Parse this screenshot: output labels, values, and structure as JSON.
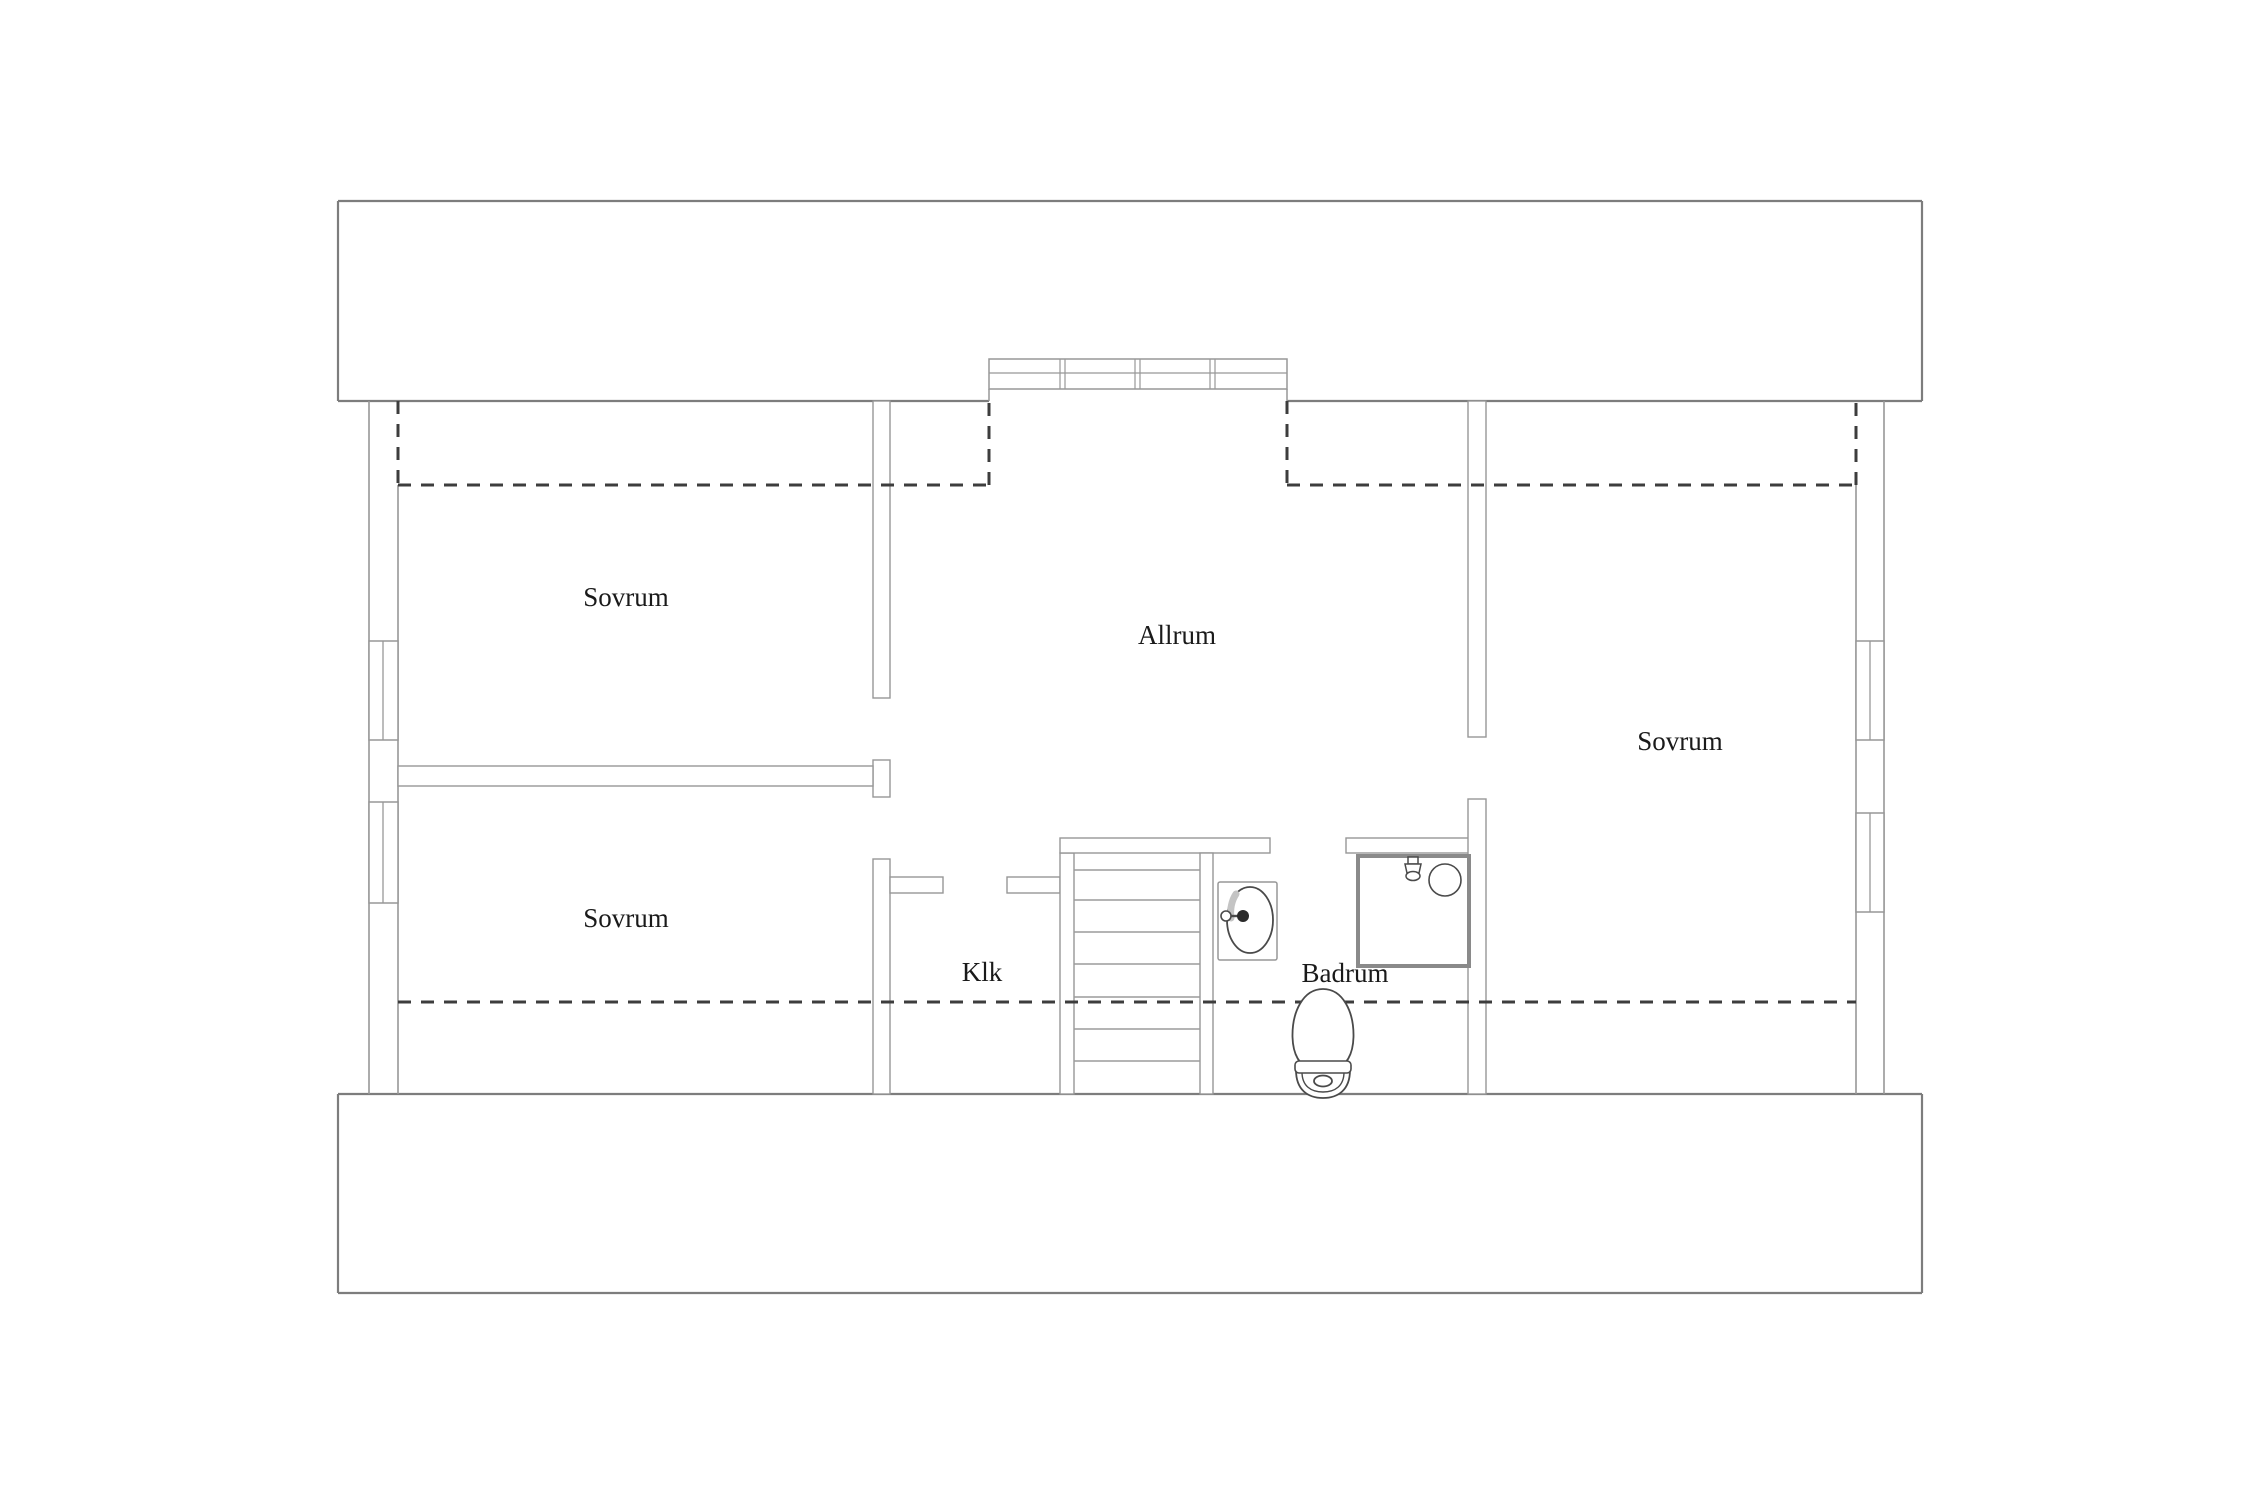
{
  "document": {
    "kind": "floor-plan",
    "language": "Swedish"
  },
  "canvas": {
    "width": 2250,
    "height": 1500,
    "background": "#ffffff"
  },
  "colors": {
    "outer_band_stroke": "#7d7d7d",
    "wall_stroke": "#979797",
    "thin_line": "#9c9c9c",
    "dashed_line": "#3d3d3d",
    "fixture_stroke": "#4a4a4a",
    "shower_stroke": "#8a8a8a",
    "shade": "#c4c4c4",
    "text": "#1a1a1a",
    "fill": "#ffffff"
  },
  "rooms": [
    {
      "id": "sovrum-top-left",
      "label": "Sovrum",
      "x": 626,
      "y": 606
    },
    {
      "id": "sovrum-bottom-left",
      "label": "Sovrum",
      "x": 626,
      "y": 927
    },
    {
      "id": "allrum",
      "label": "Allrum",
      "x": 1177,
      "y": 644
    },
    {
      "id": "sovrum-right",
      "label": "Sovrum",
      "x": 1680,
      "y": 750
    },
    {
      "id": "klk",
      "label": "Klk",
      "x": 982,
      "y": 981
    },
    {
      "id": "badrum",
      "label": "Badrum",
      "x": 1345,
      "y": 982
    }
  ],
  "label_font_size": 27,
  "outer_bands": [
    {
      "id": "top-band",
      "x": 338,
      "y": 201,
      "w": 1584,
      "h": 200,
      "bottom_gap": [
        989,
        1287
      ]
    },
    {
      "id": "bottom-band",
      "x": 338,
      "y": 1094,
      "w": 1584,
      "h": 199,
      "bottom_gap": null
    }
  ],
  "exterior_wall_lines": [
    {
      "id": "left-outer",
      "x1": 369,
      "y1": 401,
      "x2": 369,
      "y2": 1094
    },
    {
      "id": "left-inner",
      "x1": 398,
      "y1": 485,
      "x2": 398,
      "y2": 1094
    },
    {
      "id": "right-outer",
      "x1": 1884,
      "y1": 401,
      "x2": 1884,
      "y2": 1094
    },
    {
      "id": "right-inner",
      "x1": 1856,
      "y1": 485,
      "x2": 1856,
      "y2": 1094
    }
  ],
  "windows": [
    {
      "id": "left-window-upper",
      "x": 369,
      "y": 641,
      "w": 29,
      "h": 99,
      "center_x": 383
    },
    {
      "id": "left-window-lower",
      "x": 369,
      "y": 802,
      "w": 29,
      "h": 101,
      "center_x": 383
    },
    {
      "id": "right-window-upper",
      "x": 1856,
      "y": 641,
      "w": 28,
      "h": 99,
      "center_x": 1870
    },
    {
      "id": "right-window-lower",
      "x": 1856,
      "y": 813,
      "w": 28,
      "h": 99,
      "center_x": 1870
    }
  ],
  "dormer_window": {
    "x": 989,
    "y": 359,
    "w": 298,
    "h": 30,
    "mid_line_y": 373,
    "jamb_bottom_y": 401,
    "mullion_xs": [
      1060,
      1135,
      1210
    ],
    "mullion_gap": 5
  },
  "interior_walls": [
    {
      "id": "wall-sovrumTL-allrum",
      "x": 873,
      "y": 401,
      "w": 17,
      "h": 297
    },
    {
      "id": "wall-t-cap",
      "x": 873,
      "y": 760,
      "w": 17,
      "h": 37
    },
    {
      "id": "wall-between-left-sovrum",
      "x": 398,
      "y": 766,
      "w": 475,
      "h": 20
    },
    {
      "id": "wall-klk-left",
      "x": 873,
      "y": 859,
      "w": 17,
      "h": 235
    },
    {
      "id": "wall-klk-door-stub-left",
      "x": 890,
      "y": 877,
      "w": 53,
      "h": 16
    },
    {
      "id": "wall-klk-door-stub-right",
      "x": 1007,
      "y": 877,
      "w": 53,
      "h": 16
    },
    {
      "id": "wall-klk-stair",
      "x": 1060,
      "y": 853,
      "w": 14,
      "h": 241
    },
    {
      "id": "wall-stair-top",
      "x": 1060,
      "y": 838,
      "w": 210,
      "h": 15
    },
    {
      "id": "wall-stair-right",
      "x": 1200,
      "y": 853,
      "w": 13,
      "h": 241
    },
    {
      "id": "wall-badrum-top",
      "x": 1346,
      "y": 838,
      "w": 123,
      "h": 15
    },
    {
      "id": "wall-allrum-sovrumR",
      "x": 1468,
      "y": 401,
      "w": 18,
      "h": 336
    },
    {
      "id": "wall-badrum-right",
      "x": 1468,
      "y": 799,
      "w": 18,
      "h": 295
    }
  ],
  "dashed_lines": [
    {
      "id": "knee-wall-top-left-v",
      "pts": [
        [
          398,
          401
        ],
        [
          398,
          485
        ]
      ]
    },
    {
      "id": "knee-wall-top-left-h",
      "pts": [
        [
          398,
          485
        ],
        [
          989,
          485
        ]
      ]
    },
    {
      "id": "knee-wall-dormer-left",
      "pts": [
        [
          989,
          485
        ],
        [
          989,
          401
        ]
      ]
    },
    {
      "id": "knee-wall-dormer-right",
      "pts": [
        [
          1287,
          401
        ],
        [
          1287,
          485
        ]
      ]
    },
    {
      "id": "knee-wall-top-right-h",
      "pts": [
        [
          1287,
          485
        ],
        [
          1856,
          485
        ]
      ]
    },
    {
      "id": "knee-wall-top-right-v",
      "pts": [
        [
          1856,
          485
        ],
        [
          1856,
          401
        ]
      ]
    },
    {
      "id": "knee-wall-bottom",
      "pts": [
        [
          398,
          1002
        ],
        [
          1856,
          1002
        ]
      ]
    }
  ],
  "dash_pattern": "13 10",
  "stairs": {
    "tread_x1": 1074,
    "tread_x2": 1200,
    "tread_ys": [
      870,
      900,
      932,
      964,
      997,
      1029,
      1061
    ]
  },
  "fixtures": {
    "sink": {
      "box": {
        "x": 1218,
        "y": 882,
        "w": 59,
        "h": 78
      },
      "basin": {
        "cx": 1250,
        "cy": 920,
        "rx": 23,
        "ry": 33
      },
      "tap": {
        "knob_cx": 1226,
        "knob_cy": 916,
        "knob_r": 5,
        "stem_x2": 1238,
        "dot_cx": 1243,
        "dot_r": 6
      }
    },
    "shower": {
      "box": {
        "x": 1358,
        "y": 856,
        "w": 111,
        "h": 110
      },
      "drain": {
        "cx": 1445,
        "cy": 880,
        "r": 16
      },
      "head": {
        "cx": 1413,
        "top_y": 856
      }
    },
    "toilet": {
      "cx": 1323,
      "top_y": 989,
      "bottom_y": 1098
    }
  }
}
